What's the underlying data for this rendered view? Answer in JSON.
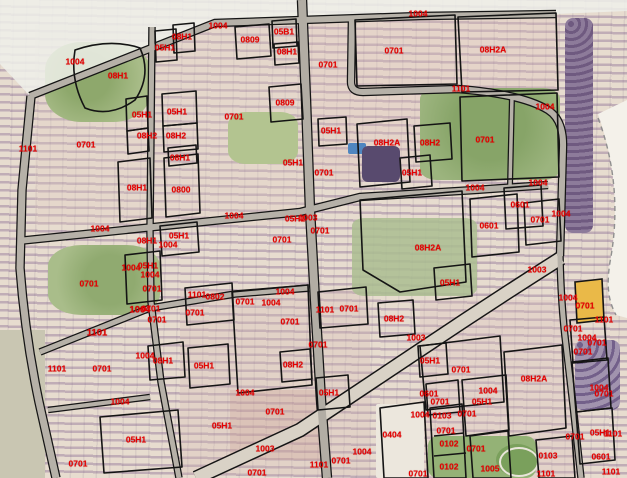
{
  "map": {
    "label_color": "#e60000",
    "boundary_color": "#141414",
    "road_fill_color": "#b6b1a8",
    "highlight_parcel_color": "#eab948",
    "highlight_parcel_label": "0701",
    "parcel_labels": [
      {
        "x": 75,
        "y": 62,
        "t": "1004"
      },
      {
        "x": 28,
        "y": 149,
        "t": "1101"
      },
      {
        "x": 118,
        "y": 76,
        "t": "08H1"
      },
      {
        "x": 165,
        "y": 48,
        "t": "05H1"
      },
      {
        "x": 182,
        "y": 37,
        "t": "08H1"
      },
      {
        "x": 218,
        "y": 26,
        "t": "1004"
      },
      {
        "x": 250,
        "y": 40,
        "t": "0809"
      },
      {
        "x": 284,
        "y": 32,
        "t": "05B1"
      },
      {
        "x": 287,
        "y": 52,
        "t": "08H1"
      },
      {
        "x": 328,
        "y": 65,
        "t": "0701"
      },
      {
        "x": 285,
        "y": 103,
        "t": "0809"
      },
      {
        "x": 394,
        "y": 51,
        "t": "0701"
      },
      {
        "x": 418,
        "y": 14,
        "t": "1004"
      },
      {
        "x": 461,
        "y": 89,
        "t": "1101"
      },
      {
        "x": 493,
        "y": 50,
        "t": "08H2A"
      },
      {
        "x": 545,
        "y": 107,
        "t": "1004"
      },
      {
        "x": 485,
        "y": 140,
        "t": "0701"
      },
      {
        "x": 142,
        "y": 115,
        "t": "05H1"
      },
      {
        "x": 177,
        "y": 112,
        "t": "05H1"
      },
      {
        "x": 147,
        "y": 136,
        "t": "08H2"
      },
      {
        "x": 176,
        "y": 136,
        "t": "08H2"
      },
      {
        "x": 86,
        "y": 145,
        "t": "0701"
      },
      {
        "x": 234,
        "y": 117,
        "t": "0701"
      },
      {
        "x": 180,
        "y": 158,
        "t": "08H1"
      },
      {
        "x": 137,
        "y": 188,
        "t": "08H1"
      },
      {
        "x": 181,
        "y": 190,
        "t": "0800"
      },
      {
        "x": 293,
        "y": 163,
        "t": "05H1"
      },
      {
        "x": 324,
        "y": 173,
        "t": "0701"
      },
      {
        "x": 331,
        "y": 131,
        "t": "05H1"
      },
      {
        "x": 412,
        "y": 173,
        "t": "05H1"
      },
      {
        "x": 430,
        "y": 143,
        "t": "08H2"
      },
      {
        "x": 387,
        "y": 143,
        "t": "08H2A"
      },
      {
        "x": 475,
        "y": 188,
        "t": "1004"
      },
      {
        "x": 538,
        "y": 183,
        "t": "1004"
      },
      {
        "x": 520,
        "y": 205,
        "t": "0601"
      },
      {
        "x": 489,
        "y": 226,
        "t": "0601"
      },
      {
        "x": 540,
        "y": 220,
        "t": "0701"
      },
      {
        "x": 561,
        "y": 214,
        "t": "1004"
      },
      {
        "x": 428,
        "y": 248,
        "t": "08H2A"
      },
      {
        "x": 450,
        "y": 283,
        "t": "05H1"
      },
      {
        "x": 100,
        "y": 229,
        "t": "1004"
      },
      {
        "x": 234,
        "y": 216,
        "t": "1004"
      },
      {
        "x": 295,
        "y": 219,
        "t": "05H1"
      },
      {
        "x": 308,
        "y": 218,
        "t": "1003"
      },
      {
        "x": 320,
        "y": 231,
        "t": "0701"
      },
      {
        "x": 282,
        "y": 240,
        "t": "0701"
      },
      {
        "x": 147,
        "y": 241,
        "t": "08H1"
      },
      {
        "x": 179,
        "y": 236,
        "t": "05H1"
      },
      {
        "x": 168,
        "y": 245,
        "t": "1004"
      },
      {
        "x": 131,
        "y": 268,
        "t": "1004"
      },
      {
        "x": 148,
        "y": 266,
        "t": "05H1"
      },
      {
        "x": 150,
        "y": 275,
        "t": "1004"
      },
      {
        "x": 152,
        "y": 289,
        "t": "0701"
      },
      {
        "x": 89,
        "y": 284,
        "t": "0701"
      },
      {
        "x": 197,
        "y": 295,
        "t": "1101"
      },
      {
        "x": 215,
        "y": 297,
        "t": "0802"
      },
      {
        "x": 195,
        "y": 313,
        "t": "0701"
      },
      {
        "x": 245,
        "y": 302,
        "t": "0701"
      },
      {
        "x": 271,
        "y": 303,
        "t": "1004"
      },
      {
        "x": 285,
        "y": 292,
        "t": "1004"
      },
      {
        "x": 290,
        "y": 322,
        "t": "0701"
      },
      {
        "x": 325,
        "y": 310,
        "t": "1101"
      },
      {
        "x": 349,
        "y": 309,
        "t": "0701"
      },
      {
        "x": 318,
        "y": 345,
        "t": "0701"
      },
      {
        "x": 97,
        "y": 333,
        "t": "1101",
        "b": 1
      },
      {
        "x": 140,
        "y": 310,
        "t": "1004",
        "b": 1
      },
      {
        "x": 151,
        "y": 309,
        "t": "0701"
      },
      {
        "x": 157,
        "y": 320,
        "t": "0701"
      },
      {
        "x": 57,
        "y": 369,
        "t": "1101"
      },
      {
        "x": 102,
        "y": 369,
        "t": "0701"
      },
      {
        "x": 145,
        "y": 356,
        "t": "1004"
      },
      {
        "x": 163,
        "y": 361,
        "t": "08H1"
      },
      {
        "x": 204,
        "y": 366,
        "t": "05H1"
      },
      {
        "x": 293,
        "y": 365,
        "t": "08H2"
      },
      {
        "x": 245,
        "y": 393,
        "t": "1004"
      },
      {
        "x": 329,
        "y": 393,
        "t": "05H1"
      },
      {
        "x": 275,
        "y": 412,
        "t": "0701"
      },
      {
        "x": 120,
        "y": 402,
        "t": "1004"
      },
      {
        "x": 136,
        "y": 440,
        "t": "05H1"
      },
      {
        "x": 78,
        "y": 464,
        "t": "0701"
      },
      {
        "x": 222,
        "y": 426,
        "t": "05H1"
      },
      {
        "x": 265,
        "y": 449,
        "t": "1003"
      },
      {
        "x": 257,
        "y": 473,
        "t": "0701"
      },
      {
        "x": 319,
        "y": 465,
        "t": "1101"
      },
      {
        "x": 341,
        "y": 461,
        "t": "0701"
      },
      {
        "x": 362,
        "y": 452,
        "t": "1004"
      },
      {
        "x": 394,
        "y": 319,
        "t": "08H2"
      },
      {
        "x": 416,
        "y": 338,
        "t": "1003"
      },
      {
        "x": 430,
        "y": 361,
        "t": "05H1"
      },
      {
        "x": 461,
        "y": 370,
        "t": "0701"
      },
      {
        "x": 534,
        "y": 379,
        "t": "08H2A"
      },
      {
        "x": 429,
        "y": 394,
        "t": "0601"
      },
      {
        "x": 440,
        "y": 402,
        "t": "0701"
      },
      {
        "x": 488,
        "y": 391,
        "t": "1004"
      },
      {
        "x": 482,
        "y": 402,
        "t": "05H1"
      },
      {
        "x": 420,
        "y": 415,
        "t": "1004"
      },
      {
        "x": 442,
        "y": 416,
        "t": "0103"
      },
      {
        "x": 467,
        "y": 414,
        "t": "0701"
      },
      {
        "x": 392,
        "y": 435,
        "t": "0404"
      },
      {
        "x": 446,
        "y": 431,
        "t": "0701"
      },
      {
        "x": 449,
        "y": 444,
        "t": "0102"
      },
      {
        "x": 449,
        "y": 467,
        "t": "0102"
      },
      {
        "x": 418,
        "y": 474,
        "t": "0701"
      },
      {
        "x": 476,
        "y": 449,
        "t": "0701"
      },
      {
        "x": 490,
        "y": 469,
        "t": "1005"
      },
      {
        "x": 537,
        "y": 270,
        "t": "1003"
      },
      {
        "x": 568,
        "y": 298,
        "t": "1004"
      },
      {
        "x": 585,
        "y": 306,
        "t": "0701"
      },
      {
        "x": 604,
        "y": 320,
        "t": "1101"
      },
      {
        "x": 573,
        "y": 329,
        "t": "0701"
      },
      {
        "x": 587,
        "y": 338,
        "t": "1004"
      },
      {
        "x": 597,
        "y": 343,
        "t": "0701"
      },
      {
        "x": 583,
        "y": 352,
        "t": "0701"
      },
      {
        "x": 599,
        "y": 388,
        "t": "1004"
      },
      {
        "x": 604,
        "y": 394,
        "t": "0701"
      },
      {
        "x": 548,
        "y": 456,
        "t": "0103"
      },
      {
        "x": 575,
        "y": 437,
        "t": "0701"
      },
      {
        "x": 600,
        "y": 433,
        "t": "05H1"
      },
      {
        "x": 613,
        "y": 434,
        "t": "1101"
      },
      {
        "x": 601,
        "y": 457,
        "t": "0601"
      },
      {
        "x": 546,
        "y": 474,
        "t": "1101"
      },
      {
        "x": 611,
        "y": 472,
        "t": "1101"
      }
    ]
  }
}
